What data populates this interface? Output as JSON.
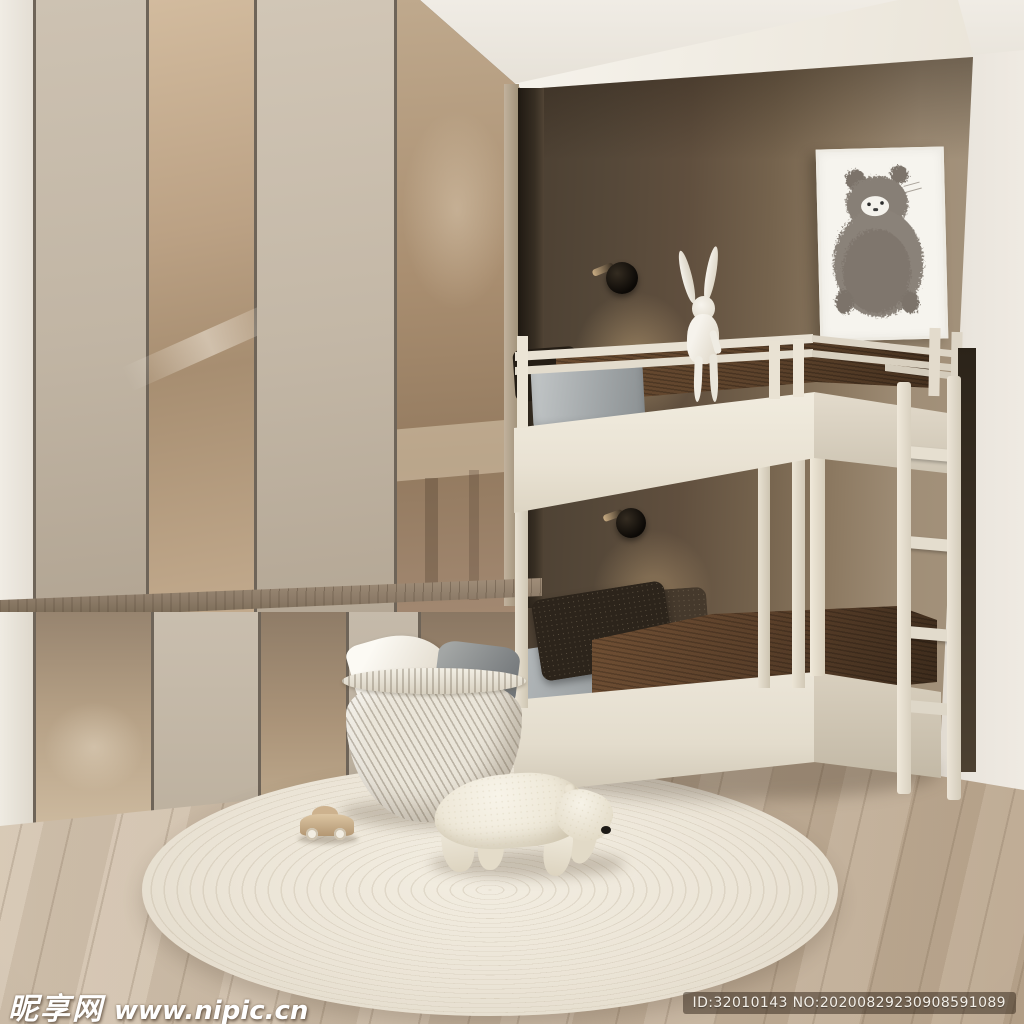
{
  "meta": {
    "type": "interior-3d-render",
    "description": "Minimalist beige children's bedroom: white bunk bed in a dark taupe niche, glossy bronze wardrobe panels, round cream rug with plush polar bear, rabbit figurine, bear sketch wall art, wicker basket with pillows and a small wooden toy car."
  },
  "watermarks": {
    "site_logo": "昵享网",
    "site_url": "www.nipic.cn",
    "id_badge": "ID:32010143 NO:20200829230908591089"
  },
  "scene": {
    "objects": [
      "wardrobe-panels",
      "wood-ledge",
      "bunk-bed",
      "ladder",
      "rabbit-figurine",
      "wall-sconces",
      "bear-wall-art",
      "wicker-basket",
      "white-pillow",
      "grey-pillow",
      "polar-bear-plush",
      "round-rug",
      "toy-car",
      "wood-floor"
    ],
    "palette": {
      "ceiling_white": "#f2efe8",
      "right_wall_white": "#eae5de",
      "niche_wall_dark": "#4e4234",
      "niche_wall_light": "#a4937c",
      "panel_matte_greige": "#c7bcab",
      "panel_gloss_bronze": "#b49c82",
      "wood_ledge": "#8d7e6c",
      "bed_frame_cream": "#eae4d7",
      "blanket_brown": "#5d4430",
      "pillow_grey": "#9aa0a2",
      "pillow_dark_knit": "#2c241b",
      "floor_wood": "#c9b9a4",
      "rug_cream": "#ece6da",
      "sconce_black": "#16120d",
      "art_bear_grey": "#847c73"
    }
  }
}
